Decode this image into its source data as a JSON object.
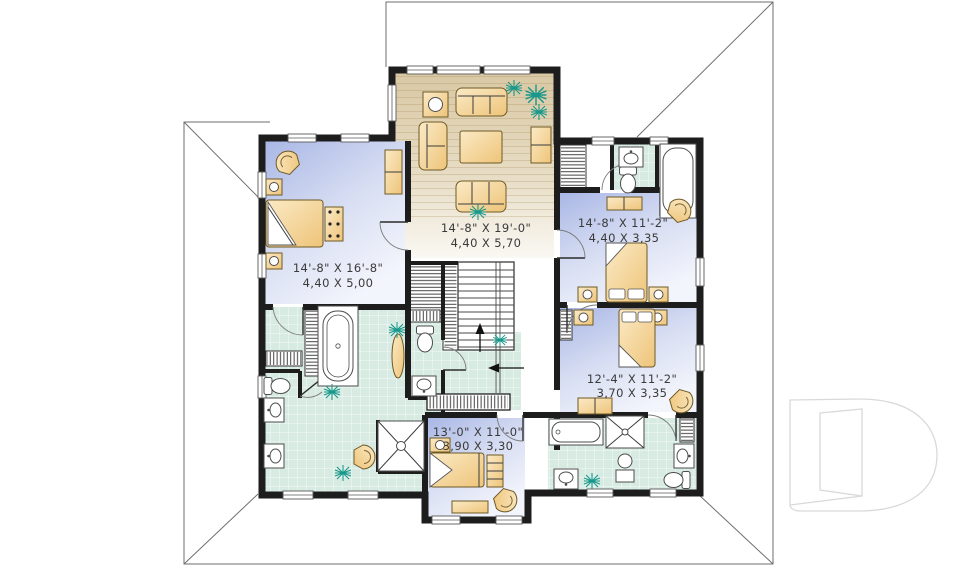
{
  "plan": {
    "rooms": [
      {
        "id": "family-room",
        "dim_imperial": "14'-8\" X 19'-0\"",
        "dim_metric": "4,40 X 5,70"
      },
      {
        "id": "master-bedroom",
        "dim_imperial": "14'-8\" X 16'-8\"",
        "dim_metric": "4,40 X 5,00"
      },
      {
        "id": "bedroom-upper-right",
        "dim_imperial": "14'-8\" X 11'-2\"",
        "dim_metric": "4,40 X 3,35"
      },
      {
        "id": "bedroom-lower-right",
        "dim_imperial": "12'-4\" X 11'-2\"",
        "dim_metric": "3,70 X 3,35"
      },
      {
        "id": "bedroom-bottom",
        "dim_imperial": "13'-0\" X 11'-0\"",
        "dim_metric": "3,90 X 3,30"
      }
    ],
    "logo_glyph": "D"
  },
  "colors": {
    "wall": "#1d1d1d",
    "bedroom-floor": "#b9c4ea",
    "wood-floor": "#e0d2b4",
    "tile-floor": "#d7ebe2",
    "furniture": "#f4d89e",
    "plant": "#17988a",
    "label": "#3a3a3a",
    "roof-line": "#6e6e6e",
    "logo-line": "#d9d9d9"
  }
}
